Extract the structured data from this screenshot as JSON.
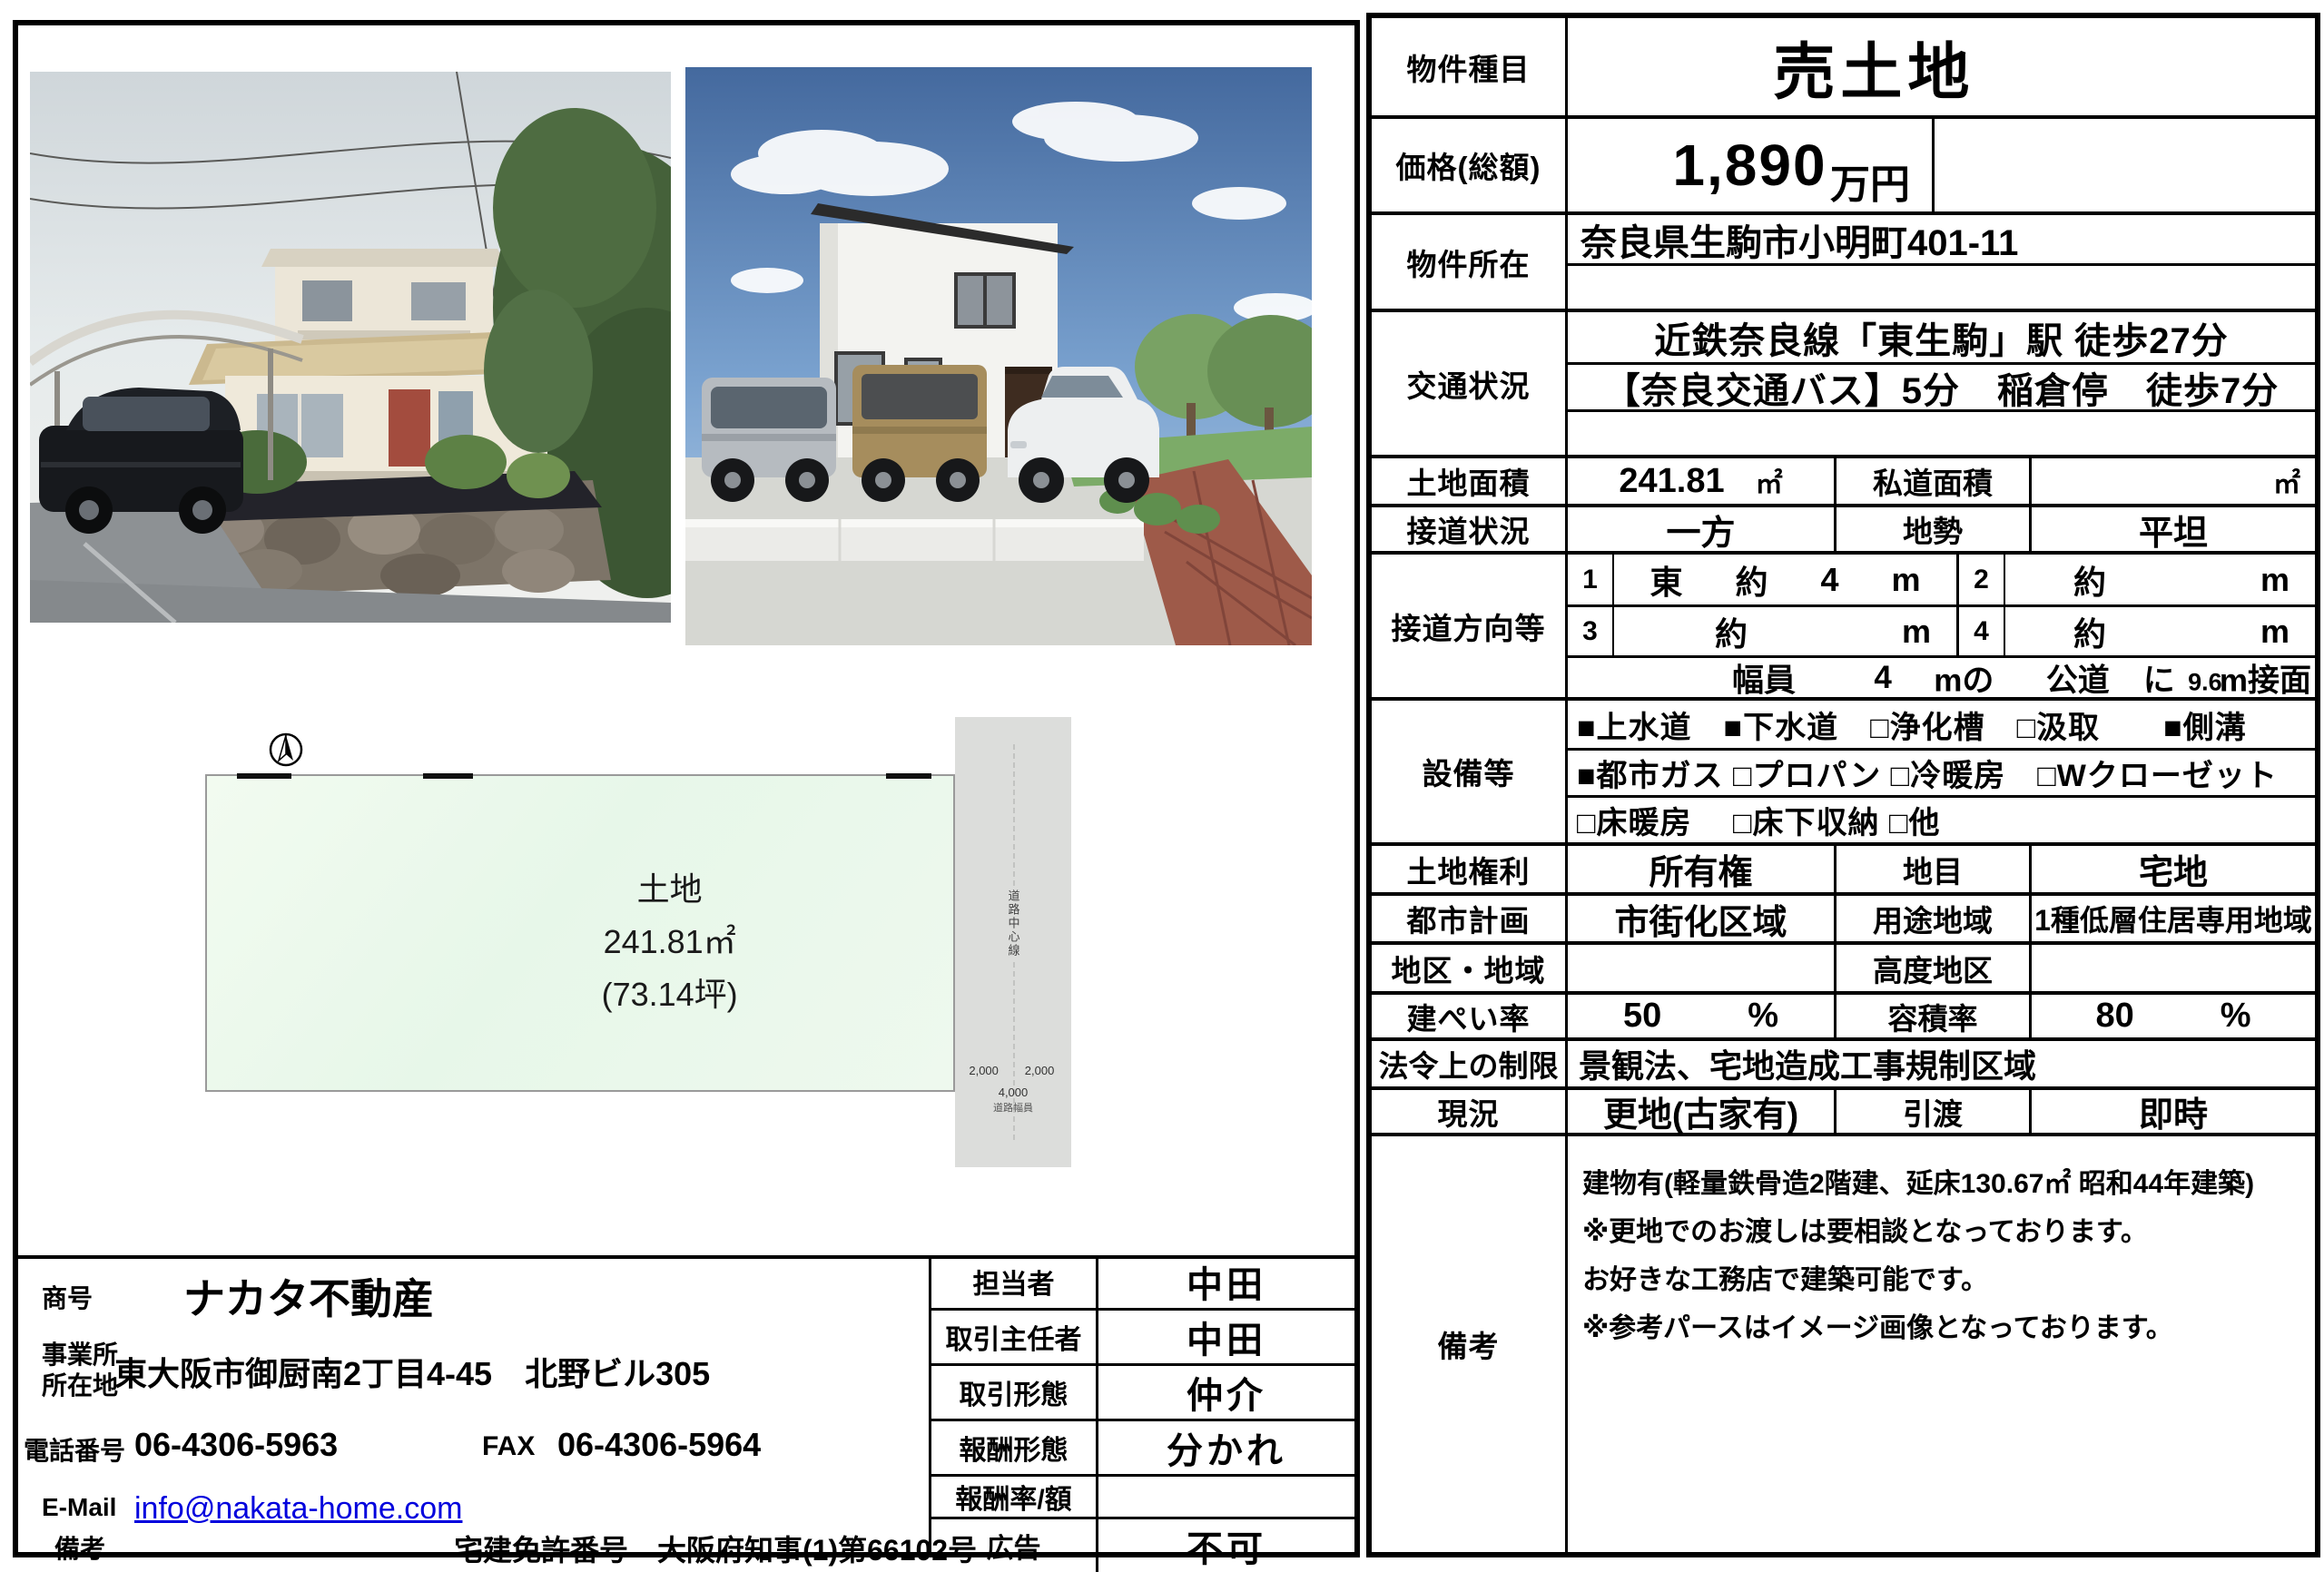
{
  "spec": {
    "type_label": "物件種目",
    "type_value": "売土地",
    "price_label": "価格(総額)",
    "price_value": "1,890",
    "price_unit": "万円",
    "location_label": "物件所在",
    "location_value": "奈良県生駒市小明町401-11",
    "transport_label": "交通状況",
    "transport_line1": "近鉄奈良線「東生駒」駅 徒歩27分",
    "transport_line2": "【奈良交通バス】5分　稲倉停　徒歩7分",
    "land_area_label": "土地面積",
    "land_area_value": "241.81",
    "land_area_unit": "㎡",
    "private_road_label": "私道面積",
    "private_road_value": "",
    "private_road_unit": "㎡",
    "road_contact_label": "接道状況",
    "road_contact_value": "一方",
    "terrain_label": "地勢",
    "terrain_value": "平坦",
    "road_dir_label": "接道方向等",
    "road_dir": {
      "n1": "1",
      "d1_dir": "東",
      "d1_about": "約",
      "d1_len": "4",
      "d1_unit": "m",
      "n2": "2",
      "d2_about": "約",
      "d2_unit": "m",
      "n3": "3",
      "d3_about": "約",
      "d3_unit": "m",
      "n4": "4",
      "d4_about": "約",
      "d4_unit": "m",
      "width_label": "幅員",
      "width_value": "4",
      "width_unit": "mの",
      "road_type": "公道",
      "particle": "に",
      "frontage": "9.6",
      "frontage_unit": "m接面"
    },
    "equipment_label": "設備等",
    "equipment_line1": "■上水道　■下水道　□浄化槽　□汲取　　■側溝",
    "equipment_line2": "■都市ガス □プロパン □冷暖房　□Wクローゼット",
    "equipment_line3": "□床暖房　 □床下収納 □他",
    "rights_label": "土地権利",
    "rights_value": "所有権",
    "category_label": "地目",
    "category_value": "宅地",
    "city_plan_label": "都市計画",
    "city_plan_value": "市街化区域",
    "zoning_label": "用途地域",
    "zoning_value": "1種低層住居専用地域",
    "district_label": "地区・地域",
    "district_value": "",
    "height_district_label": "高度地区",
    "height_district_value": "",
    "coverage_label": "建ぺい率",
    "coverage_value": "50",
    "coverage_unit": "%",
    "floor_ratio_label": "容積率",
    "floor_ratio_value": "80",
    "floor_ratio_unit": "%",
    "legal_label": "法令上の制限",
    "legal_value": "景観法、宅地造成工事規制区域",
    "status_label": "現況",
    "status_value": "更地(古家有)",
    "handover_label": "引渡",
    "handover_value": "即時",
    "remarks_label": "備考",
    "remarks_lines": [
      "建物有(軽量鉄骨造2階建、延床130.67㎡ 昭和44年建築)",
      "※更地でのお渡しは要相談となっております。",
      "お好きな工務店で建築可能です。",
      "※参考パースはイメージ画像となっております。"
    ]
  },
  "diagram": {
    "land_label": "土地",
    "land_area": "241.81㎡",
    "land_tsubo": "(73.14坪)",
    "road_center_text": "道路中心線",
    "dim_left": "2,000",
    "dim_right": "2,000",
    "dim_total": "4,000",
    "dim_caption": "道路幅員"
  },
  "company": {
    "shogo_label": "商号",
    "shogo_value": "ナカタ不動産",
    "office_label_line1": "事業所",
    "office_label_line2": "所在地",
    "office_value": "東大阪市御厨南2丁目4-45　北野ビル305",
    "tel_label": "電話番号",
    "tel_value": "06-4306-5963",
    "fax_label": "FAX",
    "fax_value": "06-4306-5964",
    "email_label": "E-Mail",
    "email_value": "info@nakata-home.com",
    "note_label": "備考",
    "license_value": "宅建免許番号　大阪府知事(1)第66102号"
  },
  "agent_table": {
    "rows": [
      {
        "label": "担当者",
        "value": "中田"
      },
      {
        "label": "取引主任者",
        "value": "中田"
      },
      {
        "label": "取引形態",
        "value": "仲介"
      },
      {
        "label": "報酬形態",
        "value": "分かれ"
      },
      {
        "label": "報酬率/額",
        "value": ""
      },
      {
        "label": "広告",
        "value": "不可"
      }
    ]
  }
}
